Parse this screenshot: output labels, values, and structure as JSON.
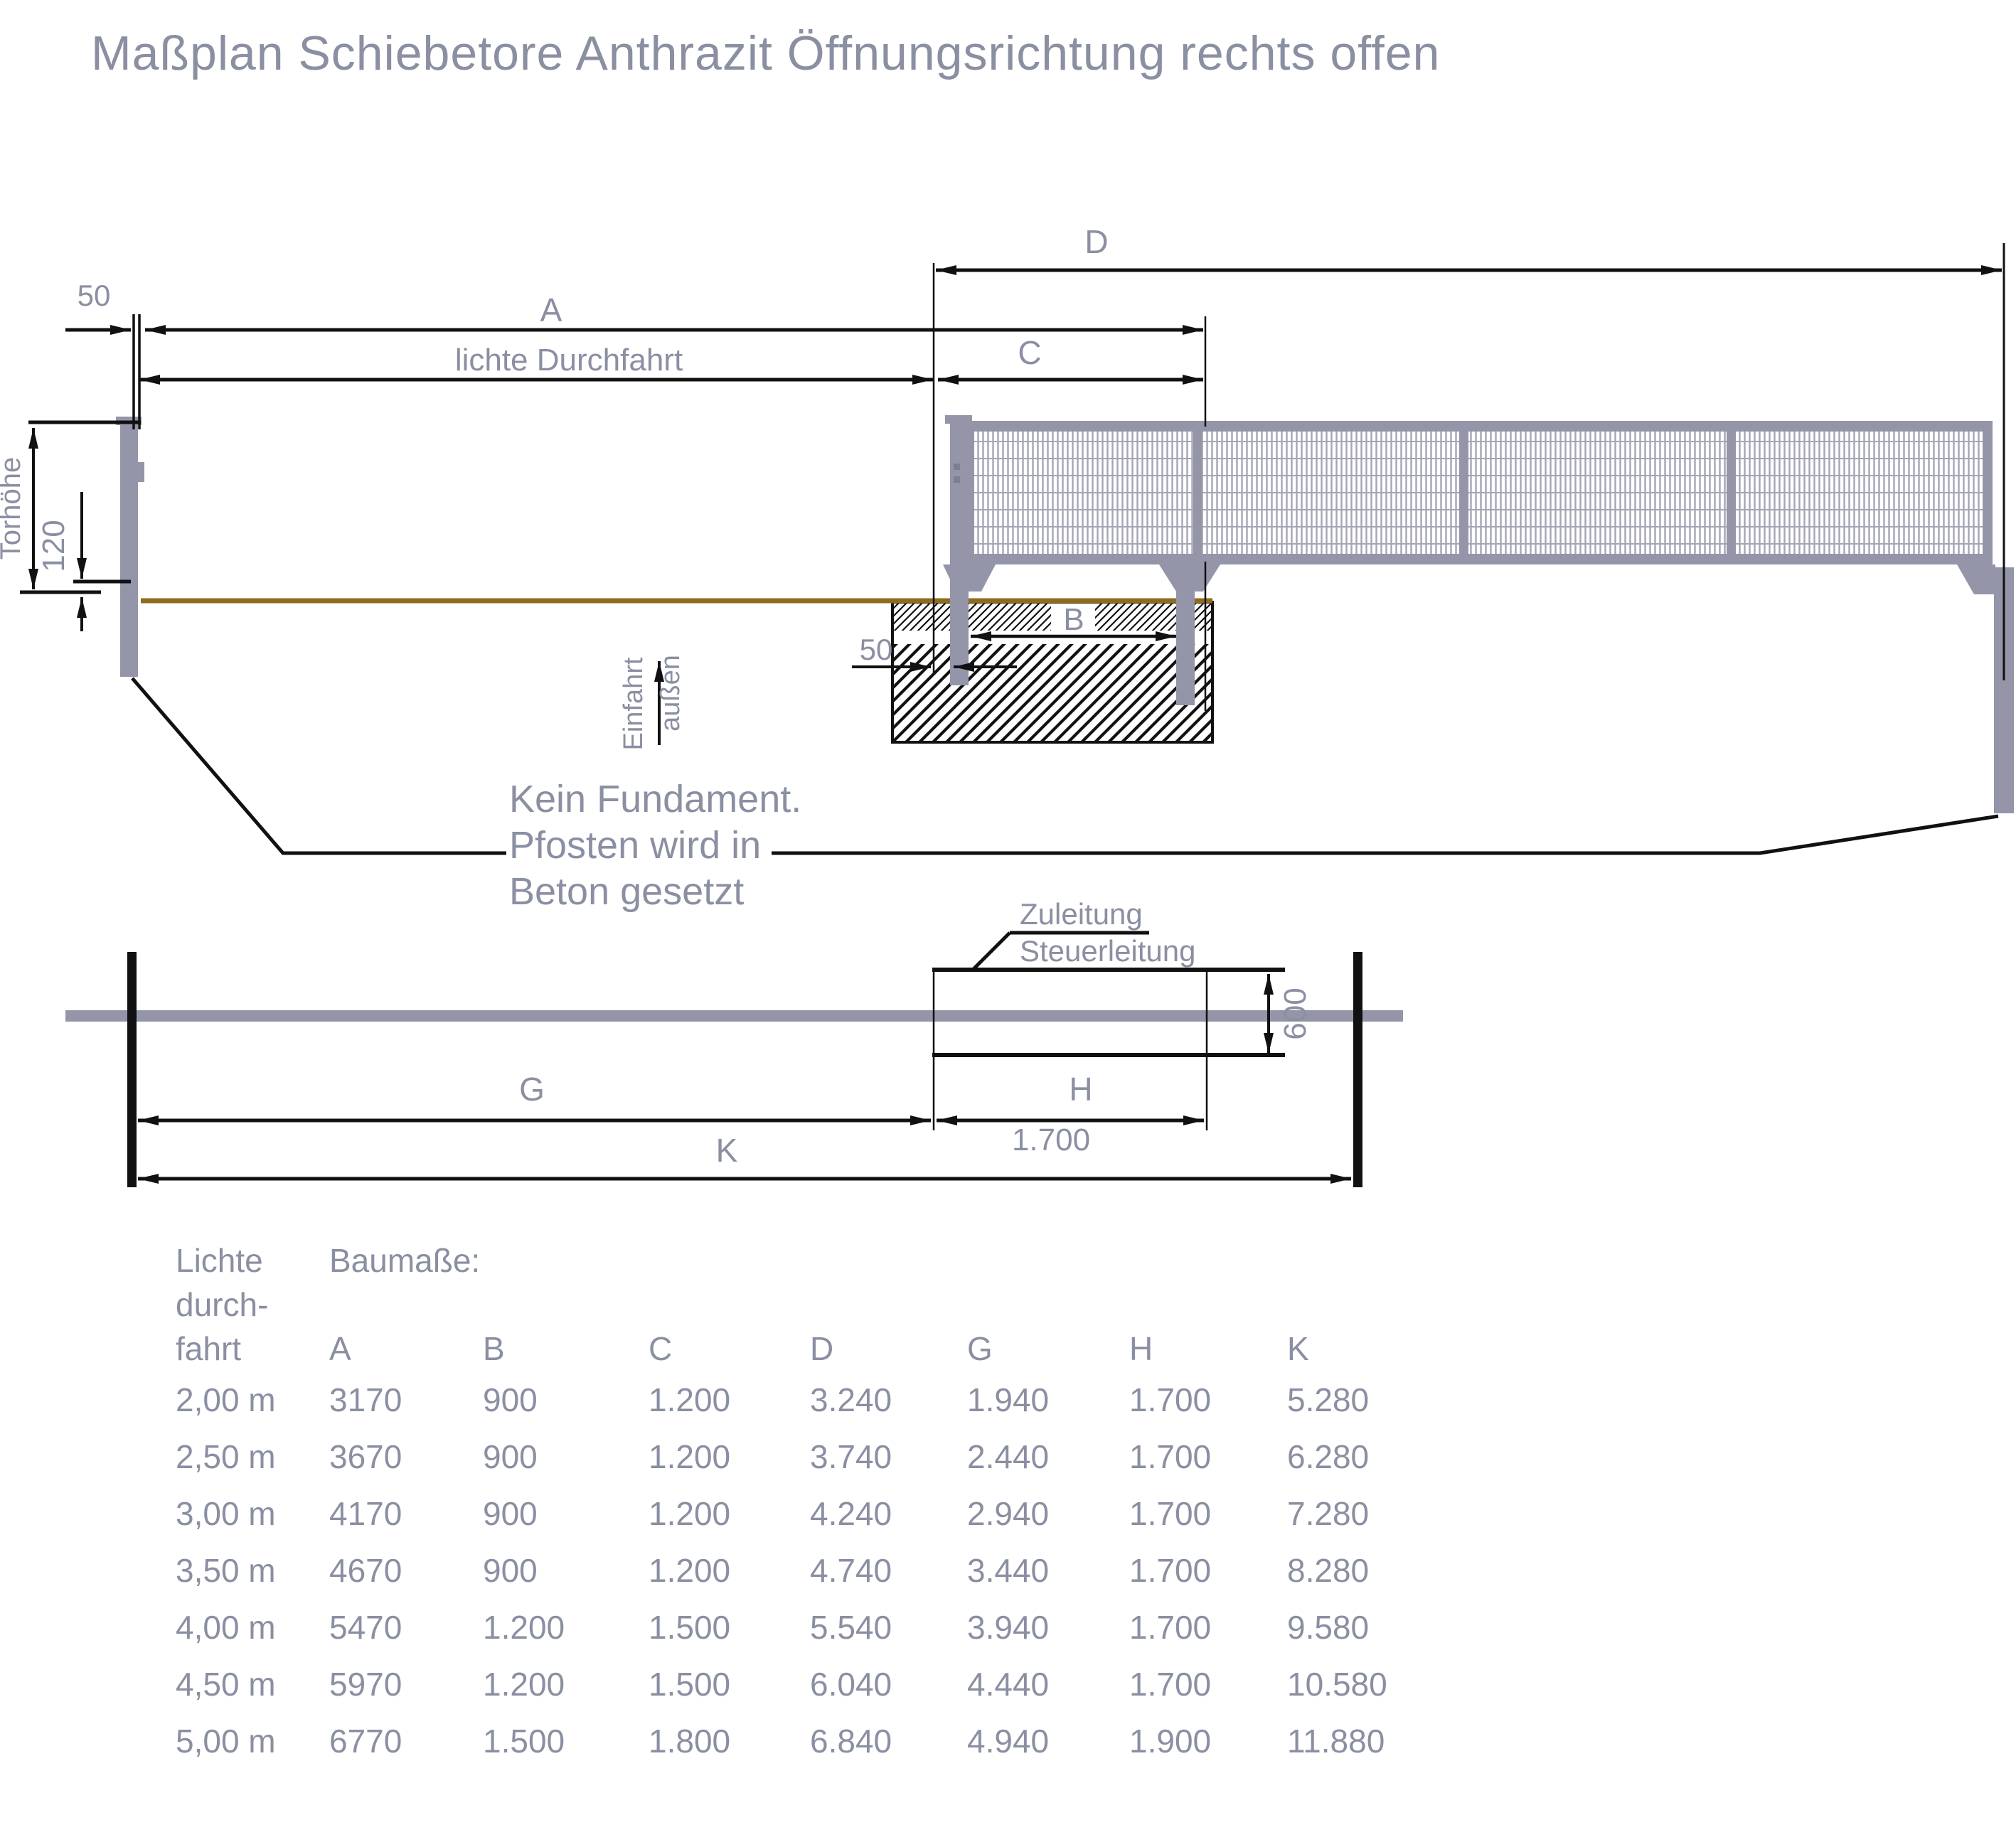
{
  "title": "Maßplan Schiebetore Anthrazit Öffnungsrichtung rechts offen",
  "colors": {
    "label_gray": "#8a8fa2",
    "line_black": "#111111",
    "steel_gray": "#9495a9",
    "mesh_gray": "#a4a6b6",
    "ground_brown": "#8e6b1f"
  },
  "elevation": {
    "dim_50_top": "50",
    "dim_a": "A",
    "dim_clear_width": "lichte Durchfahrt",
    "dim_d": "D",
    "dim_c": "C",
    "dim_b": "B",
    "dim_50_bottom": "50",
    "dim_gate_height": "Torhöhe",
    "dim_120": "120",
    "entry_label": "Einfahrt",
    "outside_label": "außen",
    "note_line1": "Kein Fundament.",
    "note_line2": "Pfosten wird in",
    "note_line3": "Beton gesetzt"
  },
  "plan": {
    "supply_line": "Zuleitung",
    "control_line": "Steuerleitung",
    "dim_600": "600",
    "dim_g": "G",
    "dim_h": "H",
    "dim_k": "K",
    "dim_1700": "1.700"
  },
  "table": {
    "col_header_line1": "Lichte",
    "col_header_line2": "durch-",
    "col_header_line3": "fahrt",
    "dims_header": "Baumaße:",
    "columns": [
      "A",
      "B",
      "C",
      "D",
      "G",
      "H",
      "K"
    ],
    "rows": [
      {
        "clear_width": "2,00 m",
        "values": [
          "3170",
          "900",
          "1.200",
          "3.240",
          "1.940",
          "1.700",
          "5.280"
        ]
      },
      {
        "clear_width": "2,50 m",
        "values": [
          "3670",
          "900",
          "1.200",
          "3.740",
          "2.440",
          "1.700",
          "6.280"
        ]
      },
      {
        "clear_width": "3,00 m",
        "values": [
          "4170",
          "900",
          "1.200",
          "4.240",
          "2.940",
          "1.700",
          "7.280"
        ]
      },
      {
        "clear_width": "3,50 m",
        "values": [
          "4670",
          "900",
          "1.200",
          "4.740",
          "3.440",
          "1.700",
          "8.280"
        ]
      },
      {
        "clear_width": "4,00 m",
        "values": [
          "5470",
          "1.200",
          "1.500",
          "5.540",
          "3.940",
          "1.700",
          "9.580"
        ]
      },
      {
        "clear_width": "4,50 m",
        "values": [
          "5970",
          "1.200",
          "1.500",
          "6.040",
          "4.440",
          "1.700",
          "10.580"
        ]
      },
      {
        "clear_width": "5,00 m",
        "values": [
          "6770",
          "1.500",
          "1.800",
          "6.840",
          "4.940",
          "1.900",
          "11.880"
        ]
      }
    ]
  }
}
